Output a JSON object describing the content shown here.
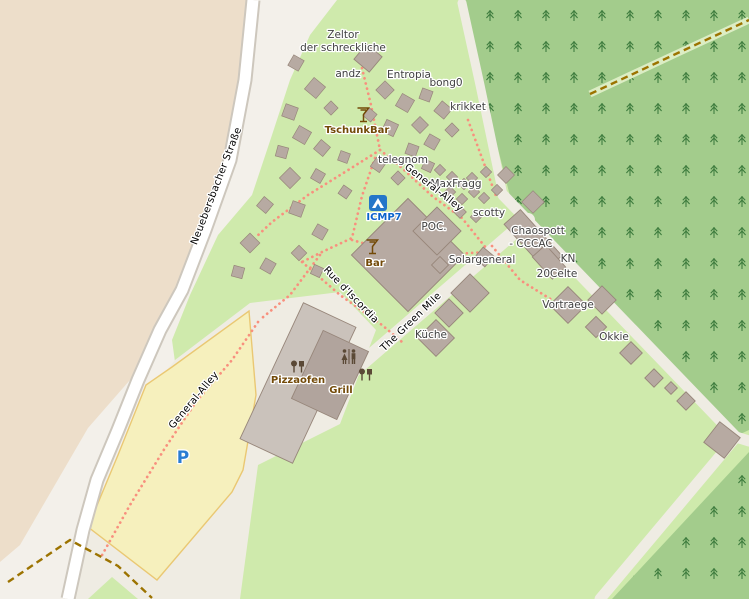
{
  "map": {
    "colors": {
      "background": "#f3f0ea",
      "farmland": "#eddeca",
      "grass": "#cfeaac",
      "forest": "#a3cc8c",
      "tree_glyph": "#3e7c3e",
      "pale_track": "#efece3",
      "road_fill": "#ffffff",
      "road_casing": "#cdc7bd",
      "parking_fill": "#f6f0bd",
      "parking_border": "#eac873",
      "path_dotted": "#f8907e",
      "track_dashed": "#9c7300",
      "track_green_corridor": "#dcedc4",
      "building_fill": "#b7aaa2",
      "building_stroke": "#97867a",
      "building_light": "#cac2bb",
      "building_dark": "#b1a49d",
      "amenity_brown": "#734a08",
      "icon_brown": "#5b4936",
      "campsite_blue": "#2476c9",
      "parking_p_blue": "#2a7cd2"
    },
    "areas": {
      "farmland": [
        [
          0,
          0
        ],
        [
          246,
          0
        ],
        [
          238,
          80
        ],
        [
          223,
          160
        ],
        [
          198,
          230
        ],
        [
          175,
          290
        ],
        [
          152,
          330
        ],
        [
          130,
          380
        ],
        [
          88,
          428
        ],
        [
          20,
          545
        ],
        [
          0,
          562
        ]
      ],
      "grass": [
        [
          337,
          0
        ],
        [
          749,
          0
        ],
        [
          749,
          599
        ],
        [
          85,
          599
        ],
        [
          100,
          520
        ],
        [
          150,
          420
        ],
        [
          175,
          362
        ],
        [
          172,
          340
        ],
        [
          190,
          295
        ],
        [
          218,
          235
        ],
        [
          252,
          195
        ],
        [
          272,
          135
        ],
        [
          290,
          80
        ],
        [
          310,
          35
        ]
      ],
      "forest1": [
        [
          460,
          0
        ],
        [
          749,
          0
        ],
        [
          749,
          430
        ],
        [
          736,
          436
        ],
        [
          510,
          196
        ]
      ],
      "forest2": [
        [
          749,
          452
        ],
        [
          749,
          599
        ],
        [
          612,
          599
        ]
      ],
      "pale_zone": [
        [
          175,
          360
        ],
        [
          250,
          303
        ],
        [
          340,
          292
        ],
        [
          376,
          330
        ],
        [
          340,
          424
        ],
        [
          258,
          465
        ],
        [
          240,
          599
        ],
        [
          70,
          599
        ],
        [
          95,
          520
        ],
        [
          148,
          393
        ]
      ],
      "parking": [
        [
          249,
          311
        ],
        [
          256,
          395
        ],
        [
          243,
          470
        ],
        [
          232,
          492
        ],
        [
          157,
          580
        ],
        [
          88,
          527
        ],
        [
          118,
          455
        ],
        [
          146,
          385
        ],
        [
          172,
          367
        ]
      ],
      "grass_triangle": [
        [
          88,
          599
        ],
        [
          138,
          599
        ],
        [
          112,
          577
        ]
      ]
    },
    "road": {
      "name": "Neuebersbacher Straße",
      "points": [
        [
          253,
          0
        ],
        [
          245,
          80
        ],
        [
          230,
          160
        ],
        [
          205,
          230
        ],
        [
          182,
          290
        ],
        [
          160,
          330
        ],
        [
          138,
          380
        ],
        [
          118,
          430
        ],
        [
          97,
          480
        ],
        [
          83,
          530
        ],
        [
          68,
          599
        ]
      ],
      "casing_width": 15,
      "fill_width": 11
    },
    "pale_tracks": [
      {
        "points": [
          [
            462,
            3
          ],
          [
            480,
            85
          ],
          [
            503,
            195
          ]
        ],
        "width": 9
      },
      {
        "points": [
          [
            503,
            195
          ],
          [
            736,
            437
          ]
        ],
        "width": 11
      },
      {
        "points": [
          [
            736,
            437
          ],
          [
            749,
            441
          ]
        ],
        "width": 11
      },
      {
        "points": [
          [
            736,
            437
          ],
          [
            600,
            599
          ]
        ],
        "width": 11
      },
      {
        "points": [
          [
            528,
            220
          ],
          [
            250,
            460
          ]
        ],
        "width": 14
      }
    ],
    "green_corridor": {
      "points": [
        [
          590,
          94
        ],
        [
          680,
          52
        ],
        [
          749,
          20
        ]
      ],
      "width": 7
    },
    "dashed_tracks": [
      [
        [
          8,
          582
        ],
        [
          70,
          540
        ],
        [
          118,
          566
        ],
        [
          152,
          598
        ]
      ],
      [
        [
          590,
          94
        ],
        [
          680,
          52
        ],
        [
          749,
          20
        ]
      ]
    ],
    "dotted_paths": [
      [
        [
          362,
          68
        ],
        [
          371,
          105
        ],
        [
          380,
          150
        ]
      ],
      [
        [
          380,
          150
        ],
        [
          402,
          168
        ],
        [
          432,
          196
        ],
        [
          462,
          218
        ],
        [
          486,
          248
        ]
      ],
      [
        [
          380,
          150
        ],
        [
          345,
          172
        ],
        [
          308,
          195
        ],
        [
          272,
          222
        ],
        [
          255,
          238
        ]
      ],
      [
        [
          375,
          158
        ],
        [
          362,
          196
        ],
        [
          352,
          238
        ],
        [
          322,
          252
        ],
        [
          302,
          262
        ]
      ],
      [
        [
          302,
          262
        ],
        [
          340,
          295
        ],
        [
          382,
          325
        ],
        [
          402,
          342
        ]
      ],
      [
        [
          320,
          255
        ],
        [
          290,
          295
        ],
        [
          262,
          318
        ]
      ],
      [
        [
          258,
          322
        ],
        [
          232,
          360
        ],
        [
          196,
          402
        ],
        [
          165,
          448
        ],
        [
          130,
          505
        ],
        [
          101,
          557
        ]
      ],
      [
        [
          468,
          120
        ],
        [
          482,
          158
        ],
        [
          496,
          196
        ]
      ],
      [
        [
          352,
          240
        ],
        [
          395,
          252
        ],
        [
          440,
          255
        ],
        [
          486,
          252
        ]
      ],
      [
        [
          492,
          246
        ],
        [
          520,
          280
        ],
        [
          552,
          300
        ]
      ]
    ],
    "tents": [
      [
        296,
        63,
        12,
        30
      ],
      [
        315,
        88,
        15,
        40
      ],
      [
        290,
        112,
        13,
        20
      ],
      [
        331,
        108,
        10,
        45
      ],
      [
        302,
        135,
        14,
        30
      ],
      [
        282,
        152,
        11,
        15
      ],
      [
        322,
        148,
        12,
        40
      ],
      [
        344,
        157,
        10,
        20
      ],
      [
        290,
        178,
        15,
        45
      ],
      [
        318,
        176,
        11,
        30
      ],
      [
        265,
        205,
        12,
        40
      ],
      [
        297,
        209,
        13,
        20
      ],
      [
        250,
        243,
        14,
        45
      ],
      [
        268,
        266,
        12,
        30
      ],
      [
        238,
        272,
        11,
        15
      ],
      [
        385,
        90,
        13,
        45
      ],
      [
        405,
        103,
        14,
        30
      ],
      [
        426,
        95,
        11,
        20
      ],
      [
        443,
        110,
        13,
        40
      ],
      [
        420,
        125,
        12,
        45
      ],
      [
        390,
        128,
        13,
        25
      ],
      [
        370,
        115,
        10,
        40
      ],
      [
        432,
        142,
        12,
        30
      ],
      [
        452,
        130,
        10,
        45
      ],
      [
        412,
        150,
        11,
        20
      ],
      [
        378,
        165,
        11,
        35
      ],
      [
        345,
        192,
        10,
        35
      ],
      [
        398,
        178,
        10,
        45
      ],
      [
        428,
        166,
        10,
        25
      ],
      [
        440,
        170,
        8,
        45
      ],
      [
        452,
        177,
        8,
        45
      ],
      [
        464,
        184,
        8,
        45
      ],
      [
        438,
        184,
        8,
        45
      ],
      [
        450,
        192,
        8,
        45
      ],
      [
        462,
        199,
        8,
        45
      ],
      [
        474,
        192,
        8,
        45
      ],
      [
        472,
        178,
        8,
        45
      ],
      [
        486,
        172,
        8,
        45
      ],
      [
        484,
        198,
        8,
        45
      ],
      [
        497,
        190,
        8,
        45
      ],
      [
        460,
        212,
        9,
        45
      ],
      [
        476,
        217,
        8,
        45
      ],
      [
        320,
        232,
        12,
        30
      ],
      [
        299,
        253,
        11,
        45
      ],
      [
        317,
        271,
        10,
        25
      ],
      [
        506,
        175,
        12,
        45
      ],
      [
        533,
        202,
        16,
        45
      ]
    ],
    "buildings": [
      {
        "x": 368,
        "y": 58,
        "w": 20,
        "h": 20,
        "r": 40,
        "shade": "fill"
      },
      {
        "x": 408,
        "y": 255,
        "w": 80,
        "h": 80,
        "r": 45,
        "shade": "fill"
      },
      {
        "x": 437,
        "y": 231,
        "w": 34,
        "h": 34,
        "r": 45,
        "shade": "fill"
      },
      {
        "x": 298,
        "y": 383,
        "w": 58,
        "h": 150,
        "r": 25,
        "shade": "light"
      },
      {
        "x": 330,
        "y": 375,
        "w": 50,
        "h": 75,
        "r": 25,
        "shade": "dark"
      },
      {
        "x": 533,
        "y": 240,
        "w": 22,
        "h": 62,
        "r": -42,
        "shade": "fill"
      },
      {
        "x": 549,
        "y": 262,
        "w": 18,
        "h": 30,
        "r": -42,
        "shade": "fill"
      },
      {
        "x": 602,
        "y": 300,
        "w": 20,
        "h": 20,
        "r": 45,
        "shade": "fill"
      },
      {
        "x": 568,
        "y": 305,
        "w": 26,
        "h": 26,
        "r": 45,
        "shade": "fill"
      },
      {
        "x": 596,
        "y": 327,
        "w": 15,
        "h": 15,
        "r": 45,
        "shade": "fill"
      },
      {
        "x": 631,
        "y": 353,
        "w": 16,
        "h": 16,
        "r": 45,
        "shade": "fill"
      },
      {
        "x": 654,
        "y": 378,
        "w": 13,
        "h": 13,
        "r": 45,
        "shade": "fill"
      },
      {
        "x": 671,
        "y": 388,
        "w": 9,
        "h": 9,
        "r": 45,
        "shade": "fill"
      },
      {
        "x": 686,
        "y": 401,
        "w": 13,
        "h": 13,
        "r": 45,
        "shade": "fill"
      },
      {
        "x": 722,
        "y": 440,
        "w": 26,
        "h": 26,
        "r": 38,
        "shade": "fill"
      },
      {
        "x": 470,
        "y": 293,
        "w": 27,
        "h": 27,
        "r": 45,
        "shade": "fill"
      },
      {
        "x": 449,
        "y": 313,
        "w": 20,
        "h": 20,
        "r": 45,
        "shade": "fill"
      },
      {
        "x": 436,
        "y": 338,
        "w": 26,
        "h": 26,
        "r": 45,
        "shade": "fill"
      },
      {
        "x": 484,
        "y": 257,
        "w": 14,
        "h": 14,
        "r": 40,
        "shade": "fill"
      },
      {
        "x": 440,
        "y": 265,
        "w": 12,
        "h": 12,
        "r": 45,
        "shade": "fill"
      }
    ],
    "labels": [
      {
        "text": "Zeltor",
        "x": 343,
        "y": 38,
        "rot": 0,
        "kind": "place"
      },
      {
        "text": "der schreckliche",
        "x": 343,
        "y": 51,
        "rot": 0,
        "kind": "place"
      },
      {
        "text": "andz",
        "x": 348,
        "y": 77,
        "rot": 0,
        "kind": "place"
      },
      {
        "text": "Entropia",
        "x": 409,
        "y": 78,
        "rot": 0,
        "kind": "place"
      },
      {
        "text": "bong0",
        "x": 446,
        "y": 86,
        "rot": 0,
        "kind": "place"
      },
      {
        "text": "krikket",
        "x": 468,
        "y": 110,
        "rot": 0,
        "kind": "place"
      },
      {
        "text": "telegnom",
        "x": 403,
        "y": 163,
        "rot": 0,
        "kind": "place"
      },
      {
        "text": "MaxFragg",
        "x": 456,
        "y": 187,
        "rot": 0,
        "kind": "place"
      },
      {
        "text": "scotty",
        "x": 489,
        "y": 216,
        "rot": 0,
        "kind": "place"
      },
      {
        "text": "Chaospott",
        "x": 538,
        "y": 234,
        "rot": 0,
        "kind": "place"
      },
      {
        "text": "- CCCAC",
        "x": 531,
        "y": 247,
        "rot": 0,
        "kind": "place"
      },
      {
        "text": "KN",
        "x": 568,
        "y": 262,
        "rot": 0,
        "kind": "place"
      },
      {
        "text": "20Celte",
        "x": 557,
        "y": 277,
        "rot": 0,
        "kind": "place"
      },
      {
        "text": "Solargeneral",
        "x": 482,
        "y": 263,
        "rot": 0,
        "kind": "place"
      },
      {
        "text": "POC.",
        "x": 434,
        "y": 230,
        "rot": 0,
        "kind": "place"
      },
      {
        "text": "Vortraege",
        "x": 568,
        "y": 308,
        "rot": 0,
        "kind": "place"
      },
      {
        "text": "Okkie",
        "x": 614,
        "y": 340,
        "rot": 0,
        "kind": "place"
      },
      {
        "text": "Küche",
        "x": 431,
        "y": 338,
        "rot": 0,
        "kind": "place"
      },
      {
        "text": "Neuebersbacher Straße",
        "x": 219,
        "y": 187,
        "rot": -69,
        "kind": "street"
      },
      {
        "text": "General-Alley",
        "x": 432,
        "y": 190,
        "rot": 38,
        "kind": "street"
      },
      {
        "text": "Rue d'Iscordia",
        "x": 349,
        "y": 297,
        "rot": 46,
        "kind": "street"
      },
      {
        "text": "The Green Mile",
        "x": 413,
        "y": 324,
        "rot": -44,
        "kind": "street"
      },
      {
        "text": "General-Alley",
        "x": 196,
        "y": 402,
        "rot": -50,
        "kind": "street"
      },
      {
        "text": "TschunkBar",
        "x": 357,
        "y": 133,
        "rot": 0,
        "kind": "amenity"
      },
      {
        "text": "Bar",
        "x": 375,
        "y": 266,
        "rot": 0,
        "kind": "amenity"
      },
      {
        "text": "Pizzaofen",
        "x": 298,
        "y": 383,
        "rot": 0,
        "kind": "amenity"
      },
      {
        "text": "Grill",
        "x": 341,
        "y": 393,
        "rot": 0,
        "kind": "amenity"
      },
      {
        "text": "ICMP7",
        "x": 384,
        "y": 220,
        "rot": 0,
        "kind": "blue"
      },
      {
        "text": "P",
        "x": 183,
        "y": 463,
        "rot": 0,
        "kind": "p"
      }
    ],
    "icons": [
      {
        "type": "cocktail",
        "name": "tschunkbar-cocktail-icon",
        "x": 363,
        "y": 117
      },
      {
        "type": "cocktail",
        "name": "bar-cocktail-icon",
        "x": 372,
        "y": 249
      },
      {
        "type": "campsite",
        "name": "campsite-icon",
        "x": 378,
        "y": 203
      },
      {
        "type": "toilets",
        "name": "toilets-icon",
        "x": 349,
        "y": 357
      },
      {
        "type": "bbq",
        "name": "pizzaofen-icon",
        "x": 298,
        "y": 367
      },
      {
        "type": "bbq",
        "name": "grill-icon",
        "x": 366,
        "y": 375
      }
    ]
  }
}
